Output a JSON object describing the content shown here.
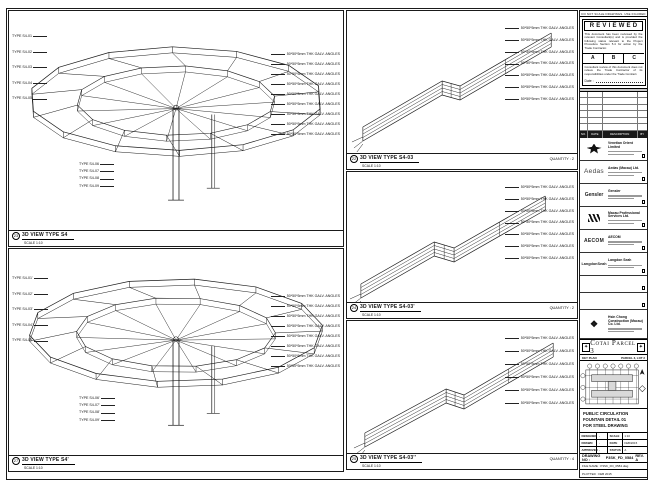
{
  "sheet": {
    "note_top": "DO NOT SCALE DRAWINGS. USE FIGURED DIMENSIONS ONLY."
  },
  "stamp": {
    "title": "REVIEWED",
    "para1": "This document has been reviewed by the relevant Consultant(s) and is provided the following status relevant to the Project Procedure Section 5.4 for action by the Trade Contractor.",
    "grades": [
      "A",
      "B",
      "C"
    ],
    "para2": "Consultant review of this document does not relieve the Trade Contractor of its responsibilities under the Trade Contract.",
    "date_label": "Date :"
  },
  "revision_table": {
    "headers": [
      "NO.",
      "DATE",
      "DESCRIPTION",
      "BY"
    ],
    "empty_rows": 6
  },
  "consultants": [
    {
      "logo": "venetian-emblem",
      "name": "Venetian Orient Limited"
    },
    {
      "logo": "Aedas",
      "name": "Aedas (Macau) Ltd."
    },
    {
      "logo": "Gensler",
      "name": "Gensler"
    },
    {
      "logo": "M",
      "name": "Macau Professional Services Ltd."
    },
    {
      "logo": "AECOM",
      "name": "AECOM"
    },
    {
      "logo": "LangdonSeah",
      "name": "Langdon Seah"
    },
    {
      "logo": "",
      "name": ""
    },
    {
      "logo": "",
      "name": ""
    },
    {
      "logo": "❖",
      "name": "Hsin Chong Construction (Macau) Co. Ltd."
    }
  ],
  "banner": {
    "title": "Cotai Parcel 3"
  },
  "key_plan": {
    "label": "KEY PLAN",
    "parcel": "PARCEL 3, LOT 2"
  },
  "title_block": {
    "title_lines": [
      "PUBLIC CIRCULATION",
      "FOUNTAIN DETAIL 01",
      "FOR STEEL DRAWING"
    ],
    "fields": [
      {
        "label": "DESIGNED",
        "value": "-",
        "label2": "SCALE",
        "value2": "1:10"
      },
      {
        "label": "DRAWN",
        "value": "-",
        "label2": "DATE",
        "value2": "FEB/2015"
      },
      {
        "label": "APPROVED",
        "value": "-",
        "label2": "STATUS",
        "value2": "A"
      }
    ],
    "drawing_no_label": "DRAWING NO :",
    "drawing_no": "P3SK_FD_0584",
    "rev": "REV. A",
    "file_name": "FILE NAME : P3SK_FD_0584.dwg",
    "plotted": "PLOTTED : FEB 2015"
  },
  "panels": {
    "s4": {
      "bubble": "23",
      "title": "3D VIEW TYPE S4",
      "scale": "SCALE 1:10",
      "quantity": "",
      "left_labels": [
        "TYPE S4-01",
        "TYPE S4-02",
        "TYPE S4-03",
        "TYPE S4-04",
        "TYPE S4-05"
      ],
      "right_labels": [
        "50*50*5mm THK GALV. ANGLES",
        "50*50*5mm THK GALV. ANGLES",
        "50*50*5mm THK GALV. ANGLES",
        "50*50*5mm THK GALV. ANGLES",
        "50*50*5mm THK GALV. ANGLES",
        "50*50*5mm THK GALV. ANGLES",
        "50*50*5mm THK GALV. ANGLES",
        "50*50*5mm THK GALV. ANGLES",
        "50*50*5mm THK GALV. ANGLES"
      ],
      "bottom_labels": [
        "TYPE S4-06",
        "TYPE S4-07",
        "TYPE S4-08",
        "TYPE S4-09"
      ]
    },
    "s4p": {
      "bubble": "27",
      "title": "3D VIEW TYPE S4'",
      "scale": "SCALE 1:10",
      "quantity": "",
      "left_labels": [
        "TYPE S4-01'",
        "TYPE S4-02'",
        "TYPE S4-03'",
        "TYPE S4-04'",
        "TYPE S4-05'"
      ],
      "right_labels": [
        "50*50*5mm THK GALV. ANGLES",
        "50*50*5mm THK GALV. ANGLES",
        "50*50*5mm THK GALV. ANGLES",
        "50*50*5mm THK GALV. ANGLES",
        "50*50*5mm THK GALV. ANGLES",
        "50*50*5mm THK GALV. ANGLES",
        "50*50*5mm THK GALV. ANGLES",
        "50*50*5mm THK GALV. ANGLES"
      ],
      "bottom_labels": [
        "TYPE S4-06'",
        "TYPE S4-07'",
        "TYPE S4-08'",
        "TYPE S4-09'"
      ]
    },
    "s403": {
      "bubble": "22",
      "title": "3D VIEW TYPE S4-03",
      "scale": "SCALE 1:10",
      "quantity": "QUANTITY : 2",
      "right_labels": [
        "50*50*5mm THK GALV. ANGLES",
        "50*50*5mm THK GALV. ANGLES",
        "50*50*5mm THK GALV. ANGLES",
        "50*50*5mm THK GALV. ANGLES",
        "50*50*5mm THK GALV. ANGLES",
        "50*50*5mm THK GALV. ANGLES",
        "50*50*5mm THK GALV. ANGLES"
      ]
    },
    "s403p": {
      "bubble": "24",
      "title": "3D VIEW TYPE S4-03'",
      "scale": "SCALE 1:10",
      "quantity": "QUANTITY : 2",
      "right_labels": [
        "50*50*5mm THK GALV. ANGLES",
        "50*50*5mm THK GALV. ANGLES",
        "50*50*5mm THK GALV. ANGLES",
        "50*50*5mm THK GALV. ANGLES",
        "50*50*5mm THK GALV. ANGLES",
        "50*50*5mm THK GALV. ANGLES",
        "50*50*5mm THK GALV. ANGLES"
      ]
    },
    "s403pp": {
      "bubble": "25",
      "title": "3D VIEW TYPE S4-03''",
      "scale": "SCALE 1:10",
      "quantity": "QUANTITY : 4",
      "right_labels": [
        "50*50*5mm THK GALV. ANGLES",
        "50*50*5mm THK GALV. ANGLES",
        "50*50*5mm THK GALV. ANGLES",
        "50*50*5mm THK GALV. ANGLES",
        "50*50*5mm THK GALV. ANGLES",
        "50*50*5mm THK GALV. ANGLES"
      ]
    }
  }
}
